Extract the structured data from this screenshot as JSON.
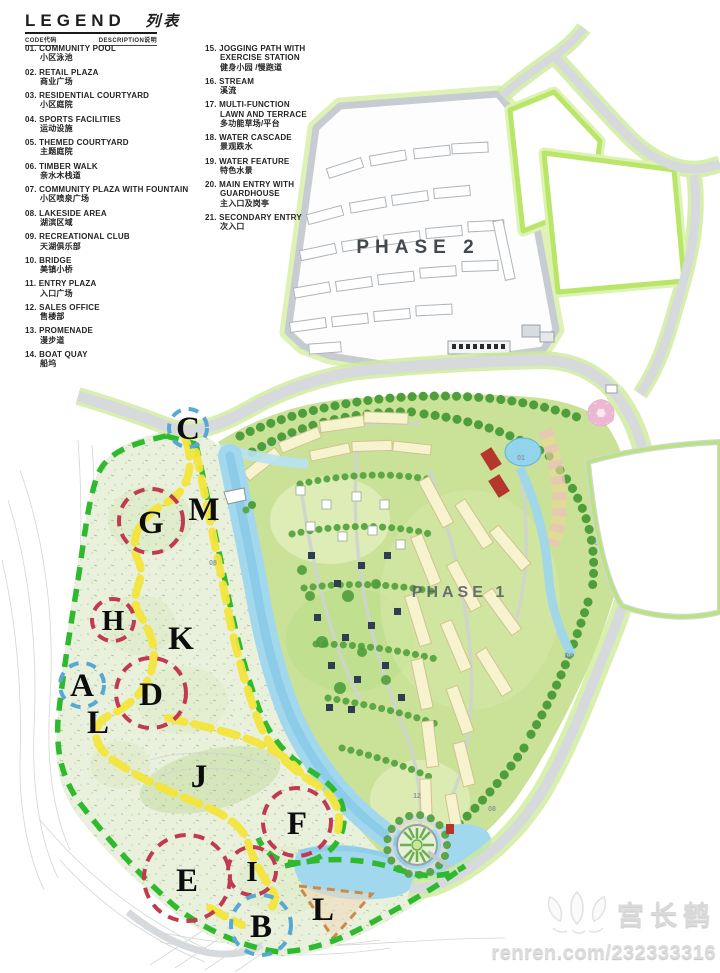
{
  "legend": {
    "title_en": "LEGEND",
    "title_zh": "列表",
    "code_header": "CODE代码",
    "desc_header": "DESCRIPTION说明",
    "items": [
      {
        "num": "01.",
        "en": "COMMUNITY POOL",
        "en2": "",
        "zh": "小区泳池"
      },
      {
        "num": "02.",
        "en": "RETAIL PLAZA",
        "en2": "",
        "zh": "商业广场"
      },
      {
        "num": "03.",
        "en": "RESIDENTIAL COURTYARD",
        "en2": "",
        "zh": "小区庭院"
      },
      {
        "num": "04.",
        "en": "SPORTS FACILITIES",
        "en2": "",
        "zh": "运动设施"
      },
      {
        "num": "05.",
        "en": "THEMED COURTYARD",
        "en2": "",
        "zh": "主题庭院"
      },
      {
        "num": "06.",
        "en": "TIMBER WALK",
        "en2": "",
        "zh": "亲水木栈道"
      },
      {
        "num": "07.",
        "en": "COMMUNITY PLAZA WITH FOUNTAIN",
        "en2": "",
        "zh": "小区喷泉广场"
      },
      {
        "num": "08.",
        "en": "LAKESIDE AREA",
        "en2": "",
        "zh": "湖滨区域"
      },
      {
        "num": "09.",
        "en": "RECREATIONAL CLUB",
        "en2": "",
        "zh": "天湖俱乐部"
      },
      {
        "num": "10.",
        "en": "BRIDGE",
        "en2": "",
        "zh": "美镇小桥"
      },
      {
        "num": "11.",
        "en": "ENTRY PLAZA",
        "en2": "",
        "zh": "入口广场"
      },
      {
        "num": "12.",
        "en": "SALES OFFICE",
        "en2": "",
        "zh": "售楼部"
      },
      {
        "num": "13.",
        "en": "PROMENADE",
        "en2": "",
        "zh": "漫步道"
      },
      {
        "num": "14.",
        "en": "BOAT QUAY",
        "en2": "",
        "zh": "船坞"
      },
      {
        "num": "15.",
        "en": "JOGGING PATH WITH",
        "en2": "EXERCISE STATION",
        "zh": "健身小园 /慢跑道"
      },
      {
        "num": "16.",
        "en": "STREAM",
        "en2": "",
        "zh": "溪流"
      },
      {
        "num": "17.",
        "en": "MULTI-FUNCTION",
        "en2": "LAWN AND TERRACE",
        "zh": "多功能草场/平台"
      },
      {
        "num": "18.",
        "en": "WATER CASCADE",
        "en2": "",
        "zh": "景观跌水"
      },
      {
        "num": "19.",
        "en": "WATER FEATURE",
        "en2": "",
        "zh": "特色水景"
      },
      {
        "num": "20.",
        "en": "MAIN ENTRY WITH",
        "en2": "GUARDHOUSE",
        "zh": "主入口及岗亭"
      },
      {
        "num": "21.",
        "en": "SECONDARY ENTRY",
        "en2": "",
        "zh": "次入口"
      }
    ]
  },
  "map": {
    "phase2_label": "PHASE 2",
    "phase1_label": "PHASE 1",
    "markers": [
      {
        "label": "C",
        "style": "blue-dashed-circle"
      },
      {
        "label": "G",
        "style": "red-dashed-circle"
      },
      {
        "label": "M",
        "style": "none"
      },
      {
        "label": "H",
        "style": "red-dashed-circle"
      },
      {
        "label": "K",
        "style": "none"
      },
      {
        "label": "A",
        "style": "blue-dashed-circle"
      },
      {
        "label": "D",
        "style": "red-dashed-circle"
      },
      {
        "label": "L",
        "style": "none"
      },
      {
        "label": "J",
        "style": "none"
      },
      {
        "label": "F",
        "style": "red-dashed-circle"
      },
      {
        "label": "E",
        "style": "red-dashed-circle"
      },
      {
        "label": "I",
        "style": "red-dashed-circle"
      },
      {
        "label": "B",
        "style": "blue-dashed-circle"
      },
      {
        "label": "L",
        "style": "none"
      }
    ],
    "plot_labels": [
      "08",
      "08",
      "D9",
      "12",
      "01"
    ]
  },
  "watermark": {
    "author": "宫长鹤",
    "url": "renren.com/232333316"
  },
  "colors": {
    "boundary_green": "#2eb92e",
    "path_yellow": "#f4e53c",
    "marker_red": "#c23a52",
    "marker_blue": "#58a8d5",
    "water_blue": "#9fd6ec",
    "road_grey": "#d5d9dc",
    "park_green": "#e9f0dc",
    "residential_green": "#c9e297",
    "building_cream": "#f8f3cf",
    "tree_green": "#4f9e3c",
    "verge_green": "#bfe97f"
  }
}
